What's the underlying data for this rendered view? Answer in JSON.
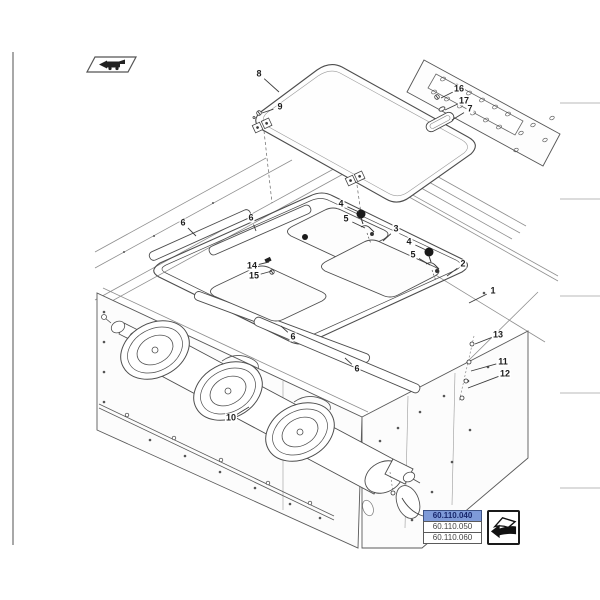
{
  "page": {
    "background": "#ffffff",
    "left_rule_color": "#a8a8a8",
    "right_tick_color": "#dcdcdc",
    "right_tick_ys": [
      102,
      198,
      295,
      392,
      487
    ]
  },
  "toolbar_icon": {
    "name": "vehicle-orientation-icon"
  },
  "diagram": {
    "type": "exploded-parts-drawing",
    "description": "Exploded isometric view of cover panel, seal frame and roller assembly",
    "line_color": "#4d4d4d",
    "knob_color": "#1a1a1a",
    "callouts": [
      {
        "label": "8",
        "x": 259,
        "y": 74,
        "tx": 279,
        "ty": 92
      },
      {
        "label": "9",
        "x": 280,
        "y": 107,
        "tx": 262,
        "ty": 113
      },
      {
        "label": "16",
        "x": 459,
        "y": 89,
        "tx": 441,
        "ty": 98
      },
      {
        "label": "17",
        "x": 464,
        "y": 101,
        "tx": 445,
        "ty": 110
      },
      {
        "label": "7",
        "x": 470,
        "y": 109,
        "tx": 452,
        "ty": 120
      },
      {
        "label": "6",
        "x": 183,
        "y": 223,
        "tx": 196,
        "ty": 236
      },
      {
        "label": "6",
        "x": 251,
        "y": 218,
        "tx": 256,
        "ty": 231
      },
      {
        "label": "4",
        "x": 341,
        "y": 204,
        "tx": 359,
        "ty": 212
      },
      {
        "label": "5",
        "x": 346,
        "y": 219,
        "tx": 365,
        "ty": 228
      },
      {
        "label": "3",
        "x": 396,
        "y": 229,
        "tx": 383,
        "ty": 241
      },
      {
        "label": "4",
        "x": 409,
        "y": 242,
        "tx": 426,
        "ty": 250
      },
      {
        "label": "5",
        "x": 413,
        "y": 255,
        "tx": 430,
        "ty": 265
      },
      {
        "label": "2",
        "x": 463,
        "y": 264,
        "tx": 447,
        "ty": 276
      },
      {
        "label": "14",
        "x": 252,
        "y": 266,
        "tx": 269,
        "ty": 262
      },
      {
        "label": "15",
        "x": 254,
        "y": 276,
        "tx": 272,
        "ty": 271
      },
      {
        "label": "1",
        "x": 493,
        "y": 291,
        "tx": 469,
        "ty": 303
      },
      {
        "label": "13",
        "x": 498,
        "y": 335,
        "tx": 475,
        "ty": 344
      },
      {
        "label": "11",
        "x": 503,
        "y": 362,
        "tx": 471,
        "ty": 371
      },
      {
        "label": "12",
        "x": 505,
        "y": 374,
        "tx": 468,
        "ty": 388
      },
      {
        "label": "6",
        "x": 293,
        "y": 337,
        "tx": 281,
        "ty": 326
      },
      {
        "label": "6",
        "x": 357,
        "y": 369,
        "tx": 345,
        "ty": 358
      },
      {
        "label": "10",
        "x": 231,
        "y": 418,
        "tx": 249,
        "ty": 407
      }
    ]
  },
  "reference_list": {
    "items": [
      {
        "code": "60.110.040",
        "selected": true
      },
      {
        "code": "60.110.050",
        "selected": false
      },
      {
        "code": "60.110.060",
        "selected": false
      }
    ],
    "selected_bg": "#7e9ad8",
    "selected_text": "#17266b"
  },
  "nav_icon": {
    "name": "page-turn-arrow-icon"
  }
}
